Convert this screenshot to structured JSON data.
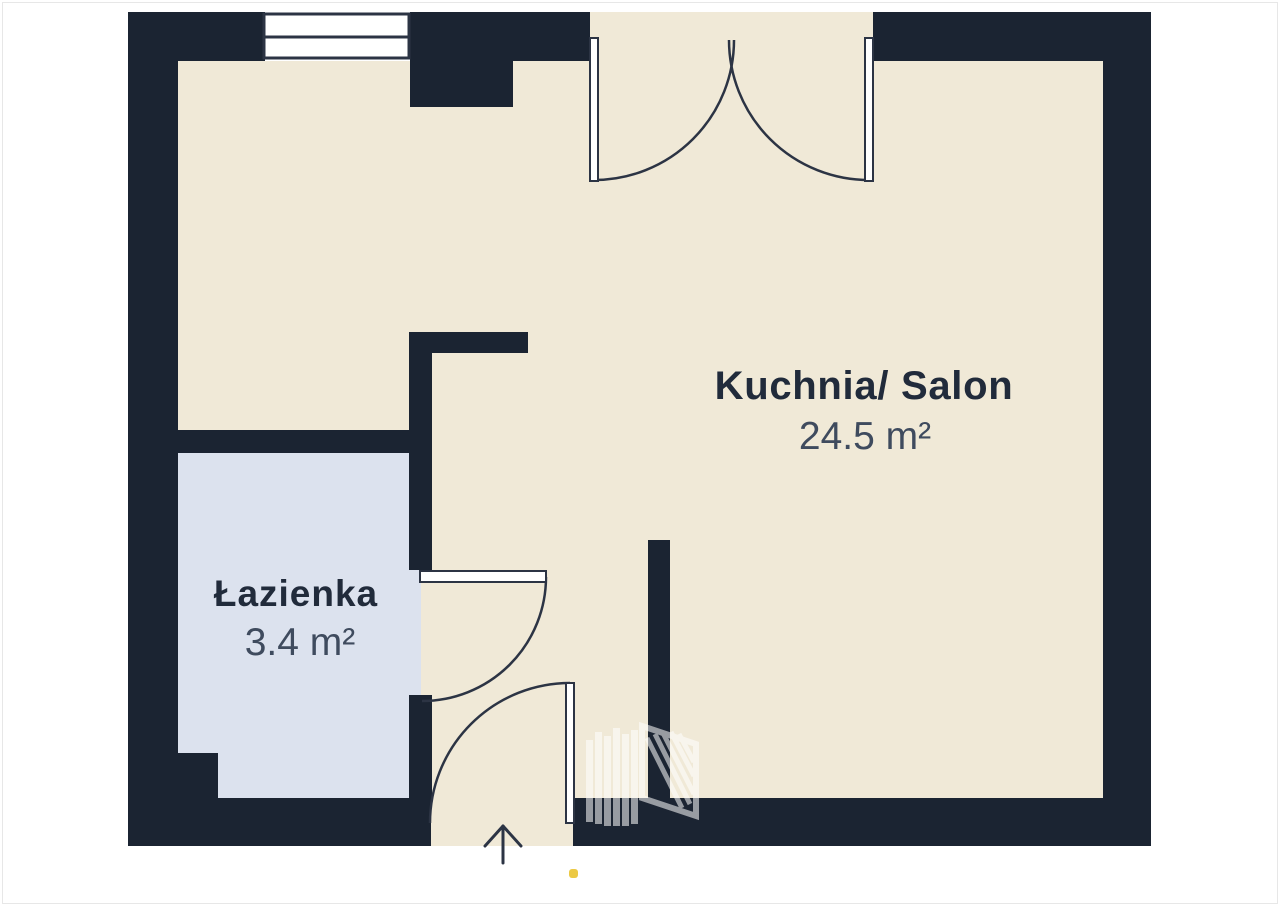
{
  "page": {
    "background": "#ffffff",
    "frame_border": "#e7e7e7"
  },
  "floorplan": {
    "rooms": [
      {
        "name": "Kuchnia/ Salon",
        "area": "24.5 m²"
      },
      {
        "name": "Łazienka",
        "area": "3.4 m²"
      }
    ],
    "colors": {
      "wall": "#1b2432",
      "floor": "#f0e9d7",
      "bathroom_floor": "#dce2ee",
      "line": "#2c3444",
      "door_fill": "#ffffff",
      "room_name": "#212b3b",
      "room_area": "#3f4b5e",
      "accent_dot": "#ecc944",
      "watermark": "#ffffff"
    },
    "icons": {
      "window": "window-symbol",
      "top_door": "double-swing-door",
      "bathroom_door": "swing-door",
      "entrance_door": "swing-door",
      "entrance_marker": "arrow-up",
      "watermark": "building-logo-watermark",
      "accent": "yellow-dot"
    }
  }
}
